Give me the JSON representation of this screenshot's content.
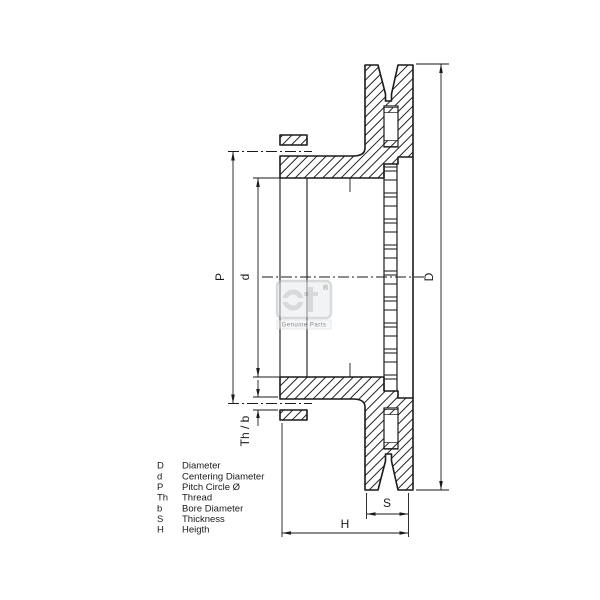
{
  "drawing": {
    "title": "brake-disc-cross-section",
    "dim_labels": {
      "D": "D",
      "d": "d",
      "P": "P",
      "th_b": "Th / b",
      "S": "S",
      "H": "H"
    }
  },
  "legend": {
    "rows": [
      {
        "symbol": "D",
        "label": "Diameter"
      },
      {
        "symbol": "d",
        "label": "Centering Diameter"
      },
      {
        "symbol": "P",
        "label": "Pitch Circle Ø"
      },
      {
        "symbol": "Th",
        "label": "Thread"
      },
      {
        "symbol": "b",
        "label": "Bore Diameter"
      },
      {
        "symbol": "S",
        "label": "Thickness"
      },
      {
        "symbol": "H",
        "label": "Heigth"
      }
    ]
  },
  "watermark": {
    "logo": "dt",
    "registered": "®",
    "caption": "Genuine Parts"
  },
  "colors": {
    "line": "#1a1a1a",
    "background": "#ffffff",
    "watermark": "#aeb6ba"
  }
}
